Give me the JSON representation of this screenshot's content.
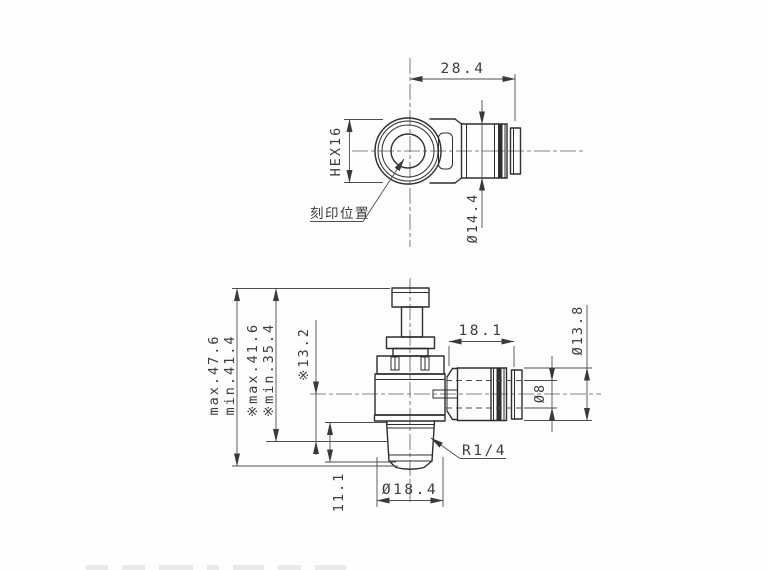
{
  "drawing": {
    "background": "#fdfdfd",
    "outline_color": "#2e2e2e",
    "dim_line_color": "#4d4d4d",
    "text_color": "#3c3c3c",
    "views": {
      "top": {
        "dims": {
          "overall_width": "28.4",
          "hex_flats": "HEX16",
          "body_diameter": "Ø14.4"
        },
        "marking_label": "刻印位置"
      },
      "front": {
        "dims": {
          "overall_max": "max.47.6",
          "overall_min": "min.41.4",
          "star_max": "※max.41.6",
          "star_min": "※min.35.4",
          "center_height": "※13.2",
          "thread_length": "11.1",
          "thread_diameter": "Ø18.4",
          "thread_spec": "R1/4",
          "fitting_length": "18.1",
          "fitting_diameter": "Ø13.8",
          "tube_diameter": "Ø8"
        }
      }
    }
  }
}
